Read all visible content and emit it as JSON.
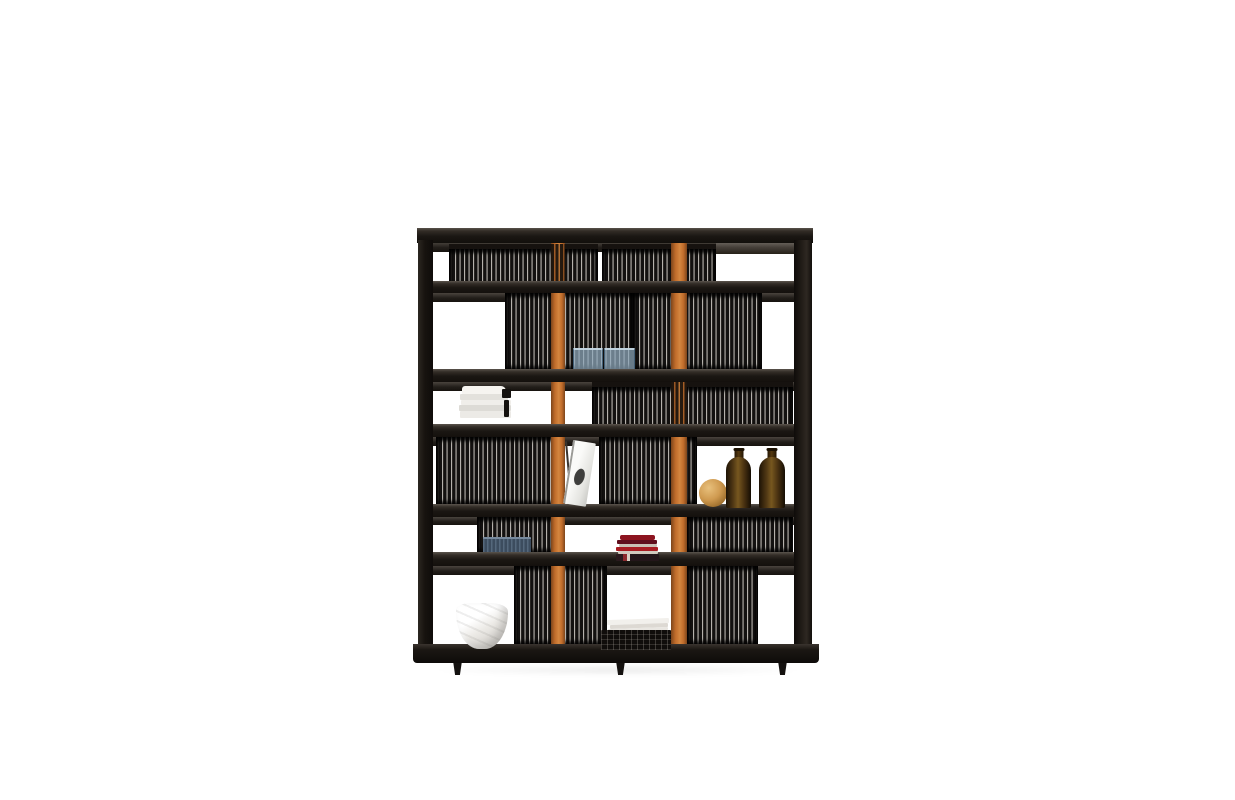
{
  "scene": {
    "type": "product-photo",
    "subject": "Black wooden bookcase with vertical slat panels and two orange leather straps, styled with decor objects, on a plain white background",
    "background": "#ffffff"
  },
  "shelf": {
    "rows": 6,
    "row_pattern": "alternating short and tall compartments",
    "straps": 2,
    "feet": 3,
    "slat_panels": 11
  },
  "palette": {
    "frame": "#1a1511",
    "slat_dark": "#131110",
    "slat_light": "#b5b1ac",
    "strap_light": "#d4863f",
    "strap_mid": "#c06c2b",
    "strap_dark": "#7c451b",
    "amber": "#77571f",
    "wood_ball": "#cf9a50",
    "navy_comb": "#3c4c5e",
    "book_red": "#a81c22",
    "white_obj": "#f4f2ee"
  },
  "objects": [
    {
      "name": "blue-cd-cases",
      "count": 2,
      "location": "row-2-center"
    },
    {
      "name": "white-book-stack",
      "count": 5,
      "location": "row-3-left"
    },
    {
      "name": "leaning-magazine",
      "count": 1,
      "location": "row-4-center"
    },
    {
      "name": "wooden-sphere",
      "count": 1,
      "location": "row-4-right"
    },
    {
      "name": "amber-glass-bottles",
      "count": 2,
      "location": "row-4-right"
    },
    {
      "name": "blue-cd-rack",
      "count": 1,
      "location": "row-5-left"
    },
    {
      "name": "red-book-stack",
      "count": 1,
      "location": "row-5-center"
    },
    {
      "name": "white-sculptural-bowl",
      "count": 1,
      "location": "row-6-left"
    },
    {
      "name": "wire-basket-with-books",
      "count": 1,
      "location": "row-6-center"
    }
  ]
}
